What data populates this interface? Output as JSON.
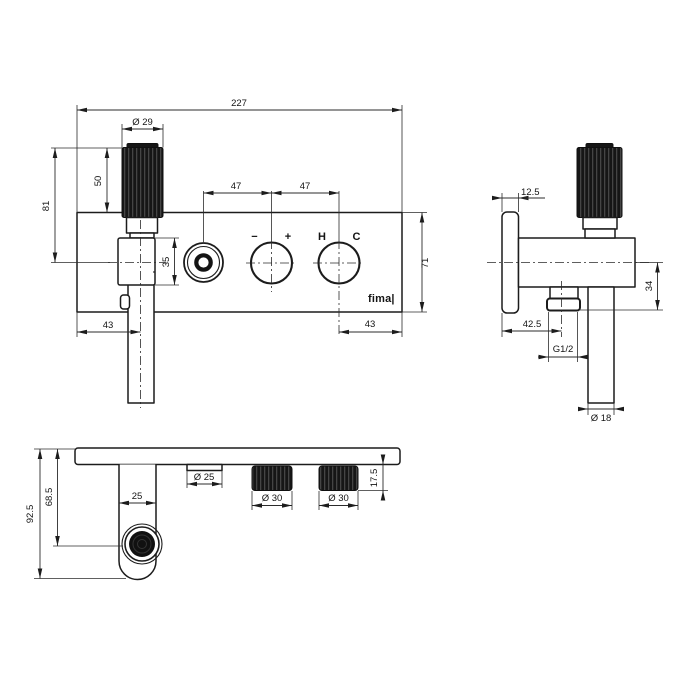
{
  "drawing": {
    "brand": "fima|",
    "front": {
      "overall_width": "227",
      "handle_diameter": "Ø 29",
      "handle_height": "50",
      "height_to_axis": "81",
      "knob_spacing_left": "47",
      "knob_spacing_right": "47",
      "holder_height": "35",
      "plate_height": "71",
      "offset_left": "43",
      "offset_right": "43",
      "label_minus": "−",
      "label_plus": "+",
      "label_hot": "H",
      "label_cold": "C"
    },
    "side": {
      "plate_thickness": "12.5",
      "outlet_drop": "34",
      "outlet_offset": "42.5",
      "thread": "G1/2",
      "pipe_diameter": "Ø 18"
    },
    "bottom": {
      "overall_depth": "92.5",
      "spray_depth": "68.5",
      "spout_width": "25",
      "diverter_diameter": "Ø 25",
      "knob1_diameter": "Ø 30",
      "knob2_diameter": "Ø 30",
      "knob_height": "17.5"
    }
  }
}
